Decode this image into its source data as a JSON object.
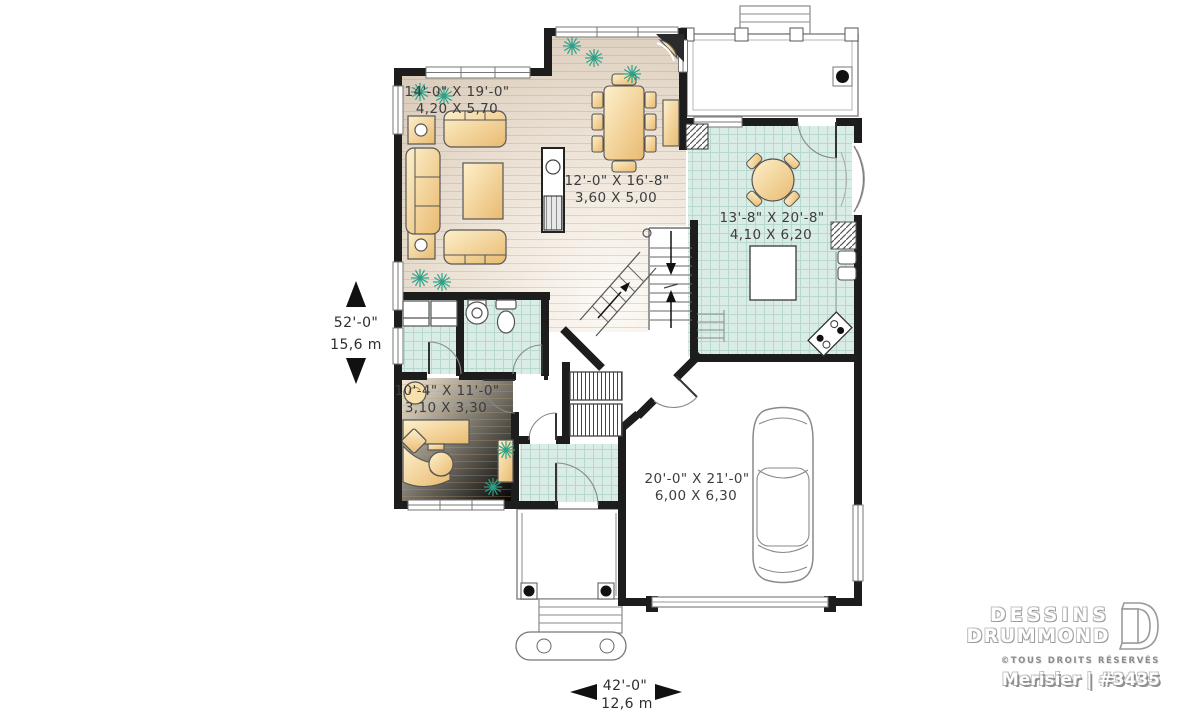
{
  "title": "House first floor plan",
  "plan": {
    "rooms": [
      {
        "name": "living-room",
        "imperial": "14'-0\" X 19'-0\"",
        "metric": "4,20 X 5,70"
      },
      {
        "name": "great-room",
        "imperial": "12'-0\" X 16'-8\"",
        "metric": "3,60 X 5,00"
      },
      {
        "name": "kitchen",
        "imperial": "13'-8\" X 20'-8\"",
        "metric": "4,10 X 6,20"
      },
      {
        "name": "office",
        "imperial": "10'-4\" X 11'-0\"",
        "metric": "3,10 X 3,30"
      },
      {
        "name": "garage",
        "imperial": "20'-0\" X 21'-0\"",
        "metric": "6,00 X 6,30"
      }
    ],
    "overall_depth": {
      "imperial": "52'-0\"",
      "metric": "15,6 m"
    },
    "overall_width": {
      "imperial": "42'-0\"",
      "metric": "12,6 m"
    },
    "colors": {
      "wall": "#1d1d1d",
      "wood_floor": "#d8c9b8",
      "tile_floor": "#daece6",
      "office_floor": "#ecdfc6",
      "furniture": "#f3d79e",
      "plant": "#2aa188",
      "thin_outline": "#777777"
    }
  },
  "branding": {
    "line1": "DESSINS",
    "line2": "DRUMMOND",
    "rights": "©TOUS DROITS RÉSERVÉS",
    "plan_label": "Merisier | #3435"
  }
}
